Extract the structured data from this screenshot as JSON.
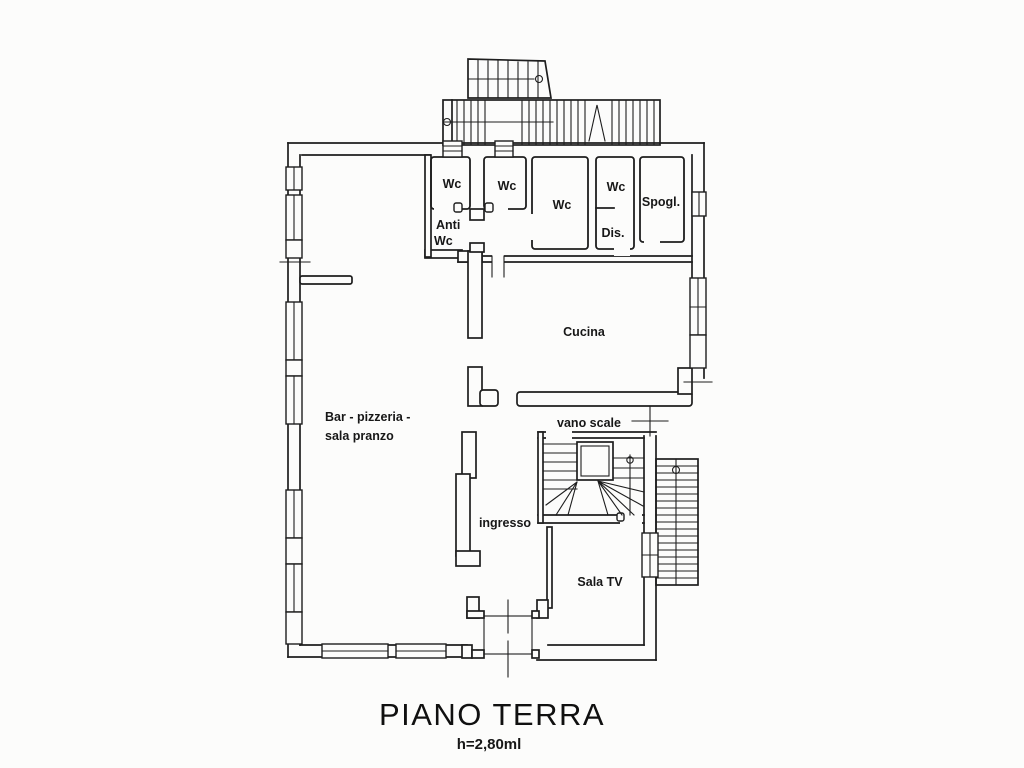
{
  "document": {
    "type": "scanned floor plan (planimetria catastale)"
  },
  "title": "PIANO TERRA",
  "subtitle": "h=2,80ml",
  "rooms": {
    "wc1": "Wc",
    "wc2": "Wc",
    "wc3": "Wc",
    "wc4": "Wc",
    "spogliatoio": "Spogl.",
    "anti_wc_line1": "Anti",
    "anti_wc_line2": "Wc",
    "disimpegno": "Dis.",
    "cucina": "Cucina",
    "bar_line1": "Bar - pizzeria -",
    "bar_line2": "sala pranzo",
    "vano_scale": "vano scale",
    "ingresso": "ingresso",
    "sala_tv": "Sala TV"
  },
  "colors": {
    "line": "#1e1e1e",
    "paper": "#fcfcfb"
  }
}
